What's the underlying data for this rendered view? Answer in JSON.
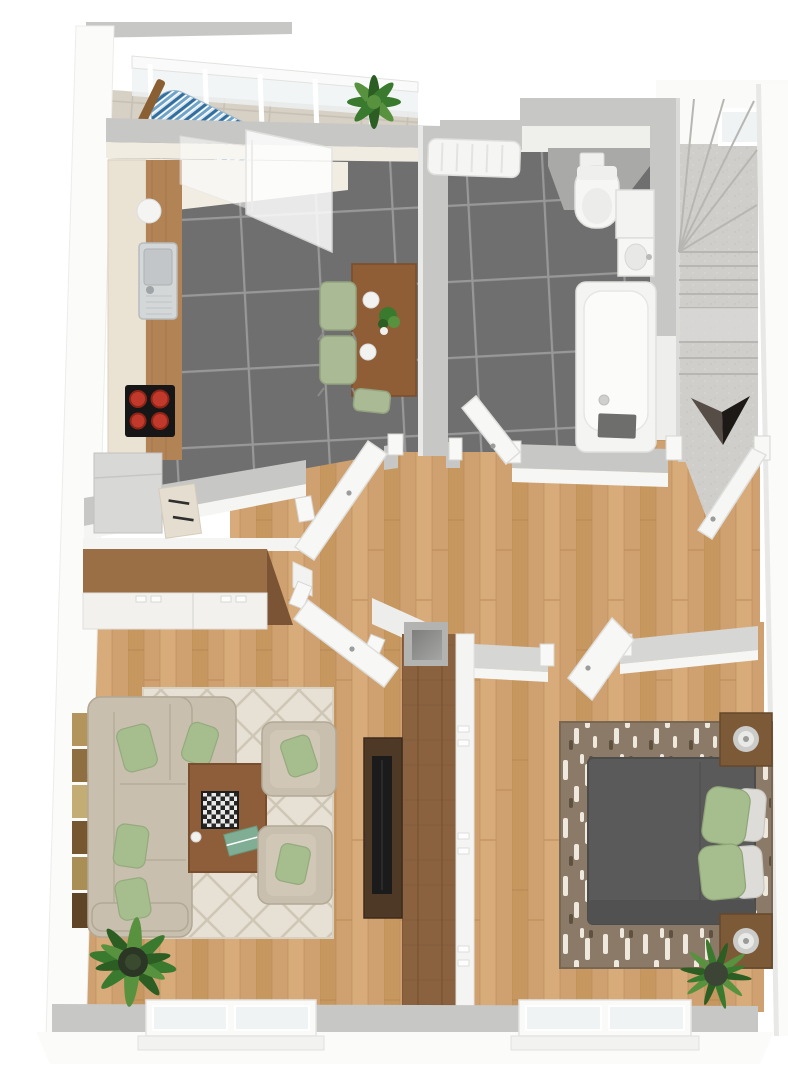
{
  "title": "3d-floor-plan-render",
  "palette": {
    "page": "#ffffff",
    "wall_top": "#c7c7c5",
    "wall_top_dark": "#a9a9a7",
    "wall_face": "#f7f7f5",
    "wall_band": "#d6d6d4",
    "tile": "#6f6f6f",
    "grout": "#989898",
    "wood": "#cfa171",
    "wood_a": "#c6975f",
    "wood_b": "#d8ab7a",
    "wood_seam": "#b98953",
    "stone": "#d7d1c5",
    "stone_line": "#c6c0b4",
    "concrete": "#cfcecb",
    "concrete_line": "#b7b6b3",
    "concrete_light": "#dadad7",
    "cabinet_cream": "#eae3d3",
    "counter_wood": "#b28355",
    "steel": "#d4d7d8",
    "steel_dark": "#b8bcbe",
    "cooktop": "#161616",
    "burner": "#c0392b",
    "appliance": "#d8d8d6",
    "table_wood": "#8f5e37",
    "chair_green": "#a9ba95",
    "sofa": "#c8bfae",
    "sofa_dark": "#b2a896",
    "pillow_green": "#a6bd8e",
    "rug_cream": "#e7e1d5",
    "rug_line": "#cfc7b6",
    "coffee_wood": "#8d5e39",
    "tv_wood": "#4e3826",
    "tv_black": "#1b1b1b",
    "plant_dark": "#2c5d22",
    "plant_mid": "#3a7a2e",
    "plant_light": "#58923f",
    "pot": "#2c3625",
    "bed": "#5a5a5a",
    "bed_dark": "#4c4c4c",
    "bedrug": "#8b7a68",
    "bedrug_light": "#efe9dd",
    "bedrug_dark": "#5e5140",
    "nightstand": "#7c5a38",
    "lamp_silver": "#cbcbc9",
    "partition_wood": "#8a6240",
    "wardrobe_wood": "#9a6f45",
    "fixture": "#f5f5f3",
    "fixture_stroke": "#dededc",
    "hammock_blue": "#336f9e",
    "hammock_mid": "#6fa3c8",
    "glass": "#eef2f4",
    "window_glass": "#eff3f4",
    "arrow_dark": "#1d1916",
    "arrow_light": "#564d47",
    "art_1": "#b3945c",
    "art_2": "#8f6f42",
    "art_3": "#c4ad74",
    "art_4": "#77572f",
    "art_5": "#a98e55",
    "art_6": "#5f4426"
  },
  "scene": {
    "type": "3d-floor-plan",
    "rooms": [
      {
        "name": "balcony",
        "objects": [
          "glazing",
          "hammock",
          "plant"
        ]
      },
      {
        "name": "kitchen",
        "objects": [
          "base-cabinets",
          "worktop",
          "sink",
          "cooktop",
          "appliance",
          "dining-table",
          "dining-chairs",
          "plates",
          "table-plant",
          "balcony-door"
        ]
      },
      {
        "name": "bathroom",
        "objects": [
          "radiator",
          "toilet",
          "flush-plate",
          "washbasin",
          "bathtub",
          "bath-mat",
          "door"
        ]
      },
      {
        "name": "stairwell",
        "objects": [
          "winder-stairs",
          "landing",
          "direction-arrow",
          "window",
          "entry-door"
        ]
      },
      {
        "name": "hallway",
        "objects": [
          "wood-floor",
          "duct-shaft",
          "doors"
        ]
      },
      {
        "name": "living-room",
        "objects": [
          "wardrobe",
          "corner-sofa",
          "green-pillows",
          "diamond-rug",
          "coffee-table",
          "chessboard",
          "magazine",
          "armchair",
          "armchair",
          "tv-unit",
          "tv",
          "wall-art",
          "plant",
          "window"
        ]
      },
      {
        "name": "bedroom",
        "objects": [
          "double-bed",
          "green-pillows",
          "white-pillows",
          "patterned-rug",
          "nightstand",
          "nightstand",
          "lamps",
          "wardrobe-partition",
          "plant",
          "window"
        ]
      }
    ],
    "compass_arrow": "points-down",
    "doors_open": [
      "kitchen",
      "bathroom",
      "living-room",
      "bedroom",
      "entry",
      "balcony"
    ]
  }
}
